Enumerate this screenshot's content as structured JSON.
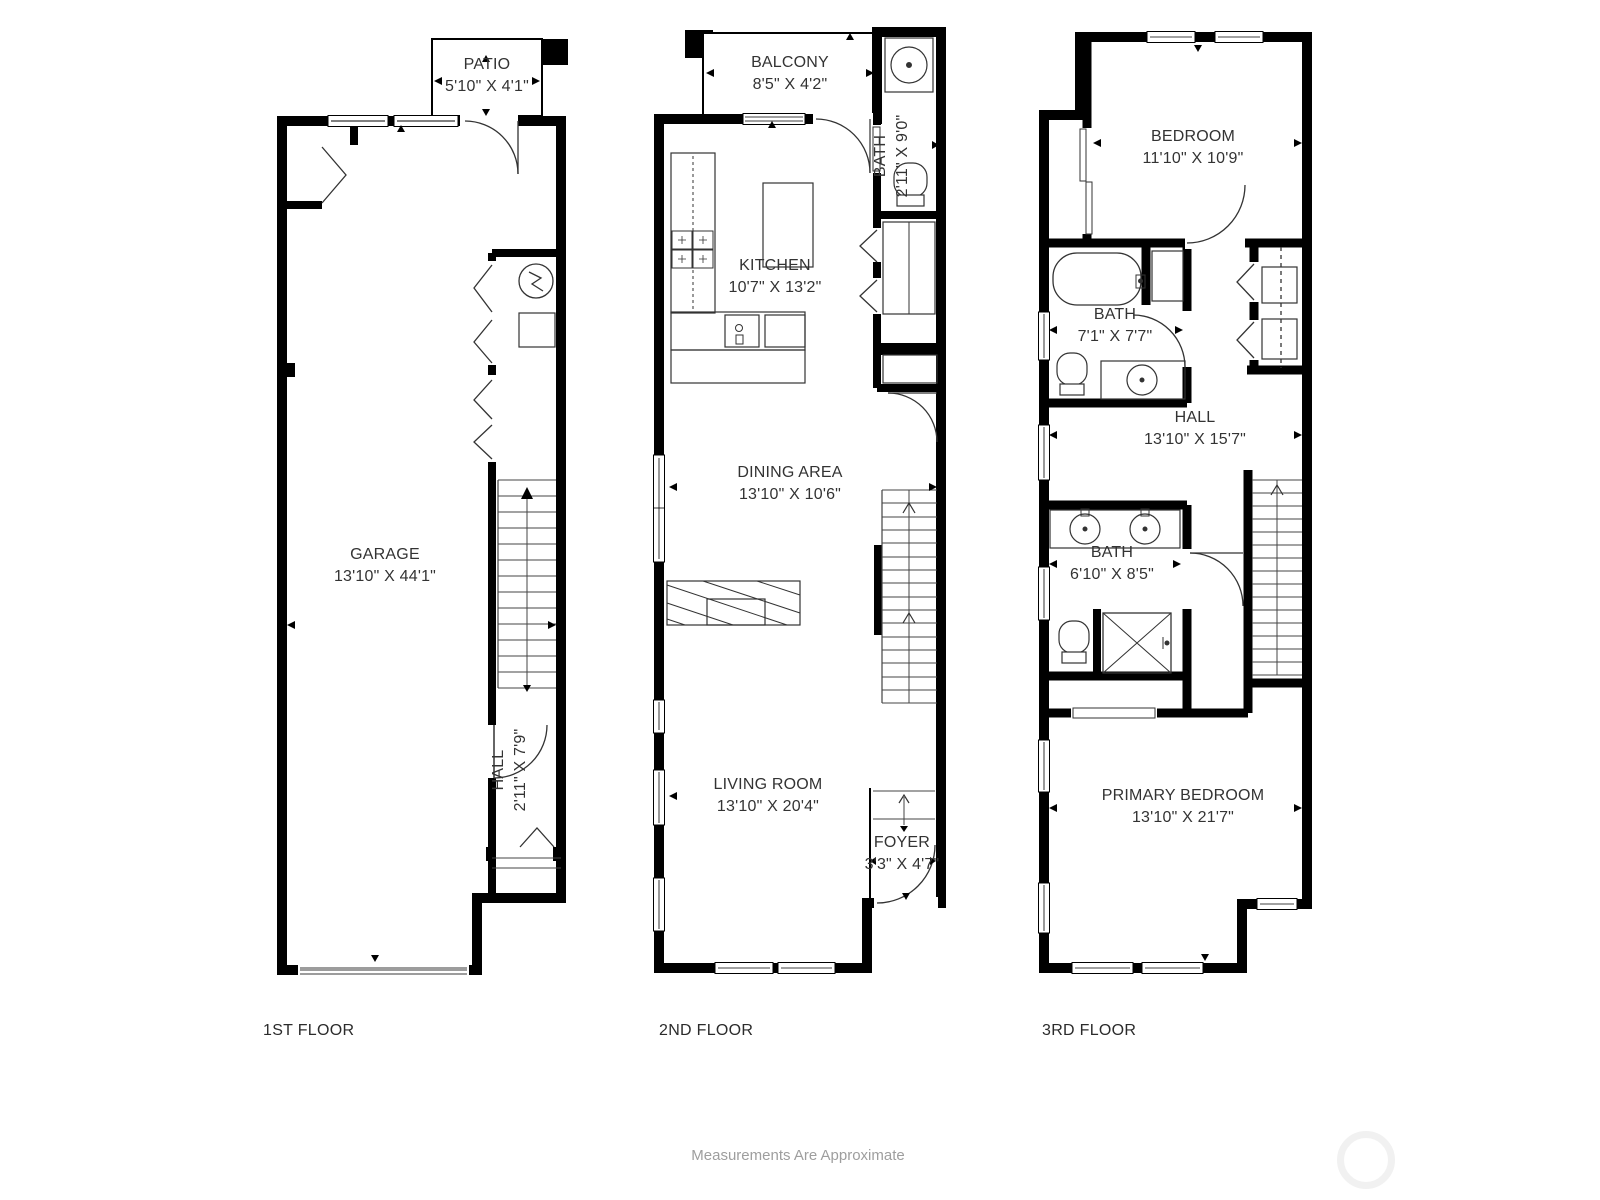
{
  "floors": [
    {
      "caption": "1ST FLOOR",
      "rooms": [
        {
          "name": "PATIO",
          "dims": "5'10\" X 4'1\""
        },
        {
          "name": "GARAGE",
          "dims": "13'10\" X 44'1\""
        },
        {
          "name": "HALL",
          "dims": "2'11\" X 7'9\""
        }
      ]
    },
    {
      "caption": "2ND FLOOR",
      "rooms": [
        {
          "name": "BALCONY",
          "dims": "8'5\" X 4'2\""
        },
        {
          "name": "BATH",
          "dims": "2'11\" X 9'0\""
        },
        {
          "name": "KITCHEN",
          "dims": "10'7\" X 13'2\""
        },
        {
          "name": "DINING AREA",
          "dims": "13'10\" X 10'6\""
        },
        {
          "name": "LIVING ROOM",
          "dims": "13'10\" X 20'4\""
        },
        {
          "name": "FOYER",
          "dims": "3'3\" X 4'7\""
        }
      ]
    },
    {
      "caption": "3RD FLOOR",
      "rooms": [
        {
          "name": "BEDROOM",
          "dims": "11'10\" X 10'9\""
        },
        {
          "name": "BATH",
          "dims": "7'1\" X 7'7\""
        },
        {
          "name": "HALL",
          "dims": "13'10\" X 15'7\""
        },
        {
          "name": "BATH",
          "dims": "6'10\" X 8'5\""
        },
        {
          "name": "PRIMARY BEDROOM",
          "dims": "13'10\" X 21'7\""
        }
      ]
    }
  ],
  "footer": "Measurements Are Approximate",
  "colors": {
    "wall": "#000000",
    "thin_line": "#333333",
    "label": "#333333",
    "caption": "#2b2b2b",
    "footer": "#9e9e9e",
    "garage_door": "#9c9c9c",
    "watermark_ring": "#f1f1f1"
  }
}
